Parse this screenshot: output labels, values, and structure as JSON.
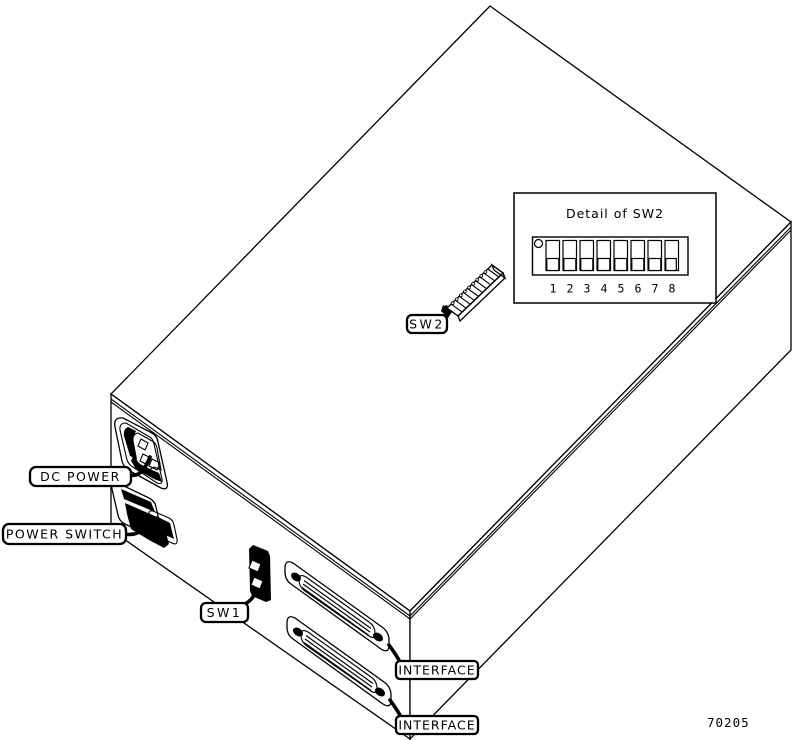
{
  "figure": {
    "part_number": "70205",
    "subject": "Rear isometric view of controller unit with switch and connector callouts"
  },
  "callouts": {
    "dc_power": "DC POWER",
    "power_switch": "POWER SWITCH",
    "sw1": "SW1",
    "sw2": "SW2",
    "interface_upper": "INTERFACE",
    "interface_lower": "INTERFACE"
  },
  "sw2_detail": {
    "title": "Detail of SW2",
    "switch_numbers": [
      "1",
      "2",
      "3",
      "4",
      "5",
      "6",
      "7",
      "8"
    ],
    "switches_drawn_position": "down"
  },
  "colors": {
    "line": "#000000",
    "background": "#ffffff"
  }
}
